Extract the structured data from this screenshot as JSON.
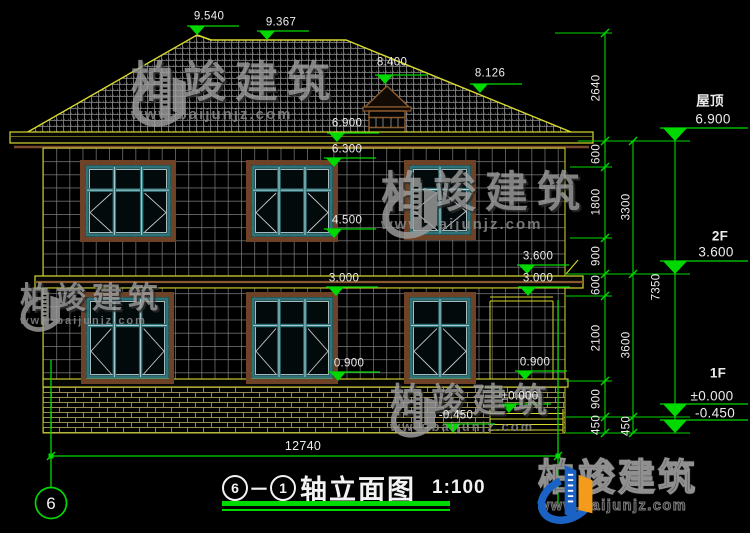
{
  "title_block": {
    "axis_start": "6",
    "separator": "－",
    "axis_end": "1",
    "name": "轴立面图",
    "scale": "1:100"
  },
  "axis_bubble": "6",
  "overall_width_dim": "12740",
  "markers": {
    "m9540": "9.540",
    "m9367": "9.367",
    "m8400": "8.400",
    "m8126": "8.126",
    "m6900": "6.900",
    "m6300": "6.300",
    "m4500": "4.500",
    "m3600": "3.600",
    "m3000": "3.000",
    "m0900": "0.900",
    "m0000": "±0.000",
    "mn450": "-0.450"
  },
  "floor_labels": {
    "roof_name": "屋顶",
    "roof_level": "6.900",
    "f2_name": "2F",
    "f2_level": "3.600",
    "f1_name": "1F",
    "f1_level": "±0.000",
    "ground_level": "-0.450"
  },
  "dims": {
    "chain1": [
      "2640",
      "600",
      "1800",
      "900",
      "600",
      "2100",
      "900",
      "450"
    ],
    "chain2": [
      "3300",
      "3600",
      "450"
    ],
    "chain3": [
      "7350"
    ]
  },
  "watermark": {
    "brand": "柏竣建筑",
    "url": "www.baijunjz.com"
  },
  "footer_logo": {
    "brand": "柏竣建筑",
    "url": "www.baijunjz.com"
  }
}
